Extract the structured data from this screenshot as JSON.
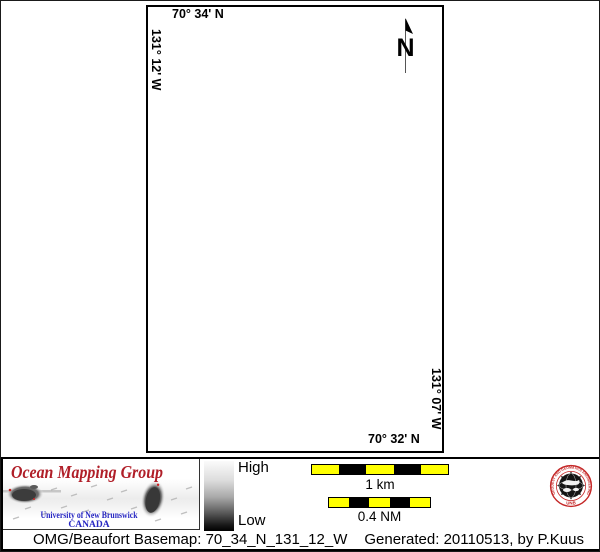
{
  "map": {
    "top_coordinate": "70° 34' N",
    "left_coordinate": "131° 12' W",
    "right_coordinate": "131° 07' W",
    "bottom_coordinate": "70° 32' N",
    "north_arrow_label": "N"
  },
  "colorbar": {
    "high_label": "High",
    "low_label": "Low"
  },
  "scalebars": {
    "bars": [
      {
        "label": "1 km",
        "segments": [
          "#FFFF00",
          "#000000",
          "#FFFF00",
          "#000000",
          "#FFFF00"
        ]
      },
      {
        "label": "0.4 NM",
        "segments": [
          "#FFFF00",
          "#000000",
          "#FFFF00",
          "#000000",
          "#FFFF00"
        ]
      }
    ]
  },
  "logo": {
    "title": "Ocean Mapping Group",
    "institution": "University of New Brunswick",
    "country": "CANADA"
  },
  "seal": {
    "ring_text": "GEODESY AND GEOMATICS ENGINEERING",
    "acronym": "UNB"
  },
  "caption": {
    "basemap": "OMG/Beaufort Basemap: 70_34_N_131_12_W",
    "generated": "Generated: 20110513, by P.Kuus"
  },
  "colors": {
    "logo_title_red": "#B01E28",
    "unb_blue": "#2727C3",
    "scale_yellow": "#FFFF00",
    "seal_red": "#C42727"
  }
}
